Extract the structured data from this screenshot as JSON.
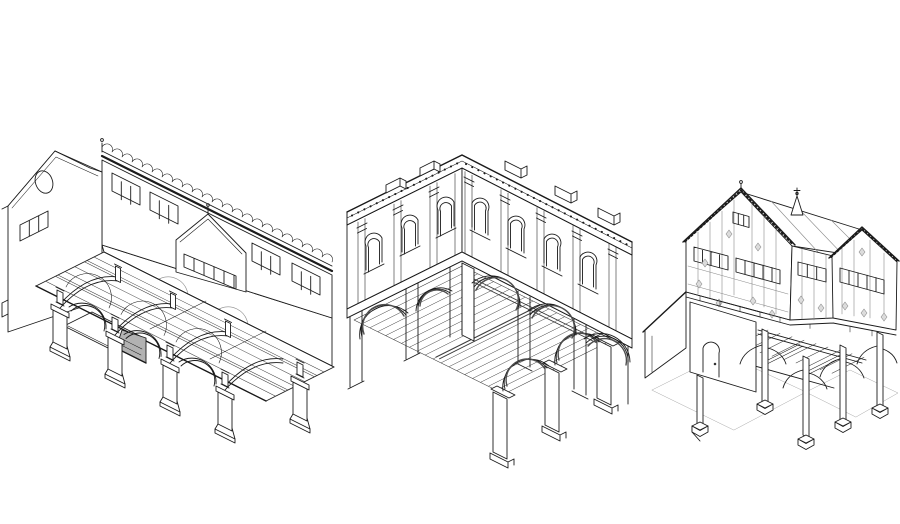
{
  "canvas": {
    "width": 900,
    "height": 524,
    "background": "#ffffff"
  },
  "palette": {
    "ink": "#1b1b1b",
    "paper": "#ffffff",
    "stair_shade": "#b2b2b2",
    "arch_soffit": "#4f4f4f",
    "panel_diamond": "#dcdcdc",
    "hatch": "#3c3c3c",
    "ground_line": "#a8a8a8"
  },
  "figures": [
    {
      "id": "left",
      "name": "arcaded-hall-cutaway-axonometric",
      "description": "Cutaway axonometric of a long arcaded masonry hall: end gable with oval window, crested roofline with clerestory windows, cross-gable, two-tier arcade on piers, exposed joist floor and grey stair flight"
    },
    {
      "id": "middle",
      "name": "classical-market-hall-axonometric",
      "description": "Axonometric of a two-storey classical hall: pilastered upper storey with round-arched windows, dentilled cornice, open ground-floor arcade on piers, joisted ceiling seen through the arches, free-standing interior piers"
    },
    {
      "id": "right",
      "name": "timber-framed-market-hall-axonometric",
      "description": "Axonometric of a timber-framed market house: jettied upper storey with twin gables, toothed bargeboards, mullioned window bands, lozenge panels, open ground floor on posts with curved braces and pad stones, arched doorway"
    }
  ]
}
